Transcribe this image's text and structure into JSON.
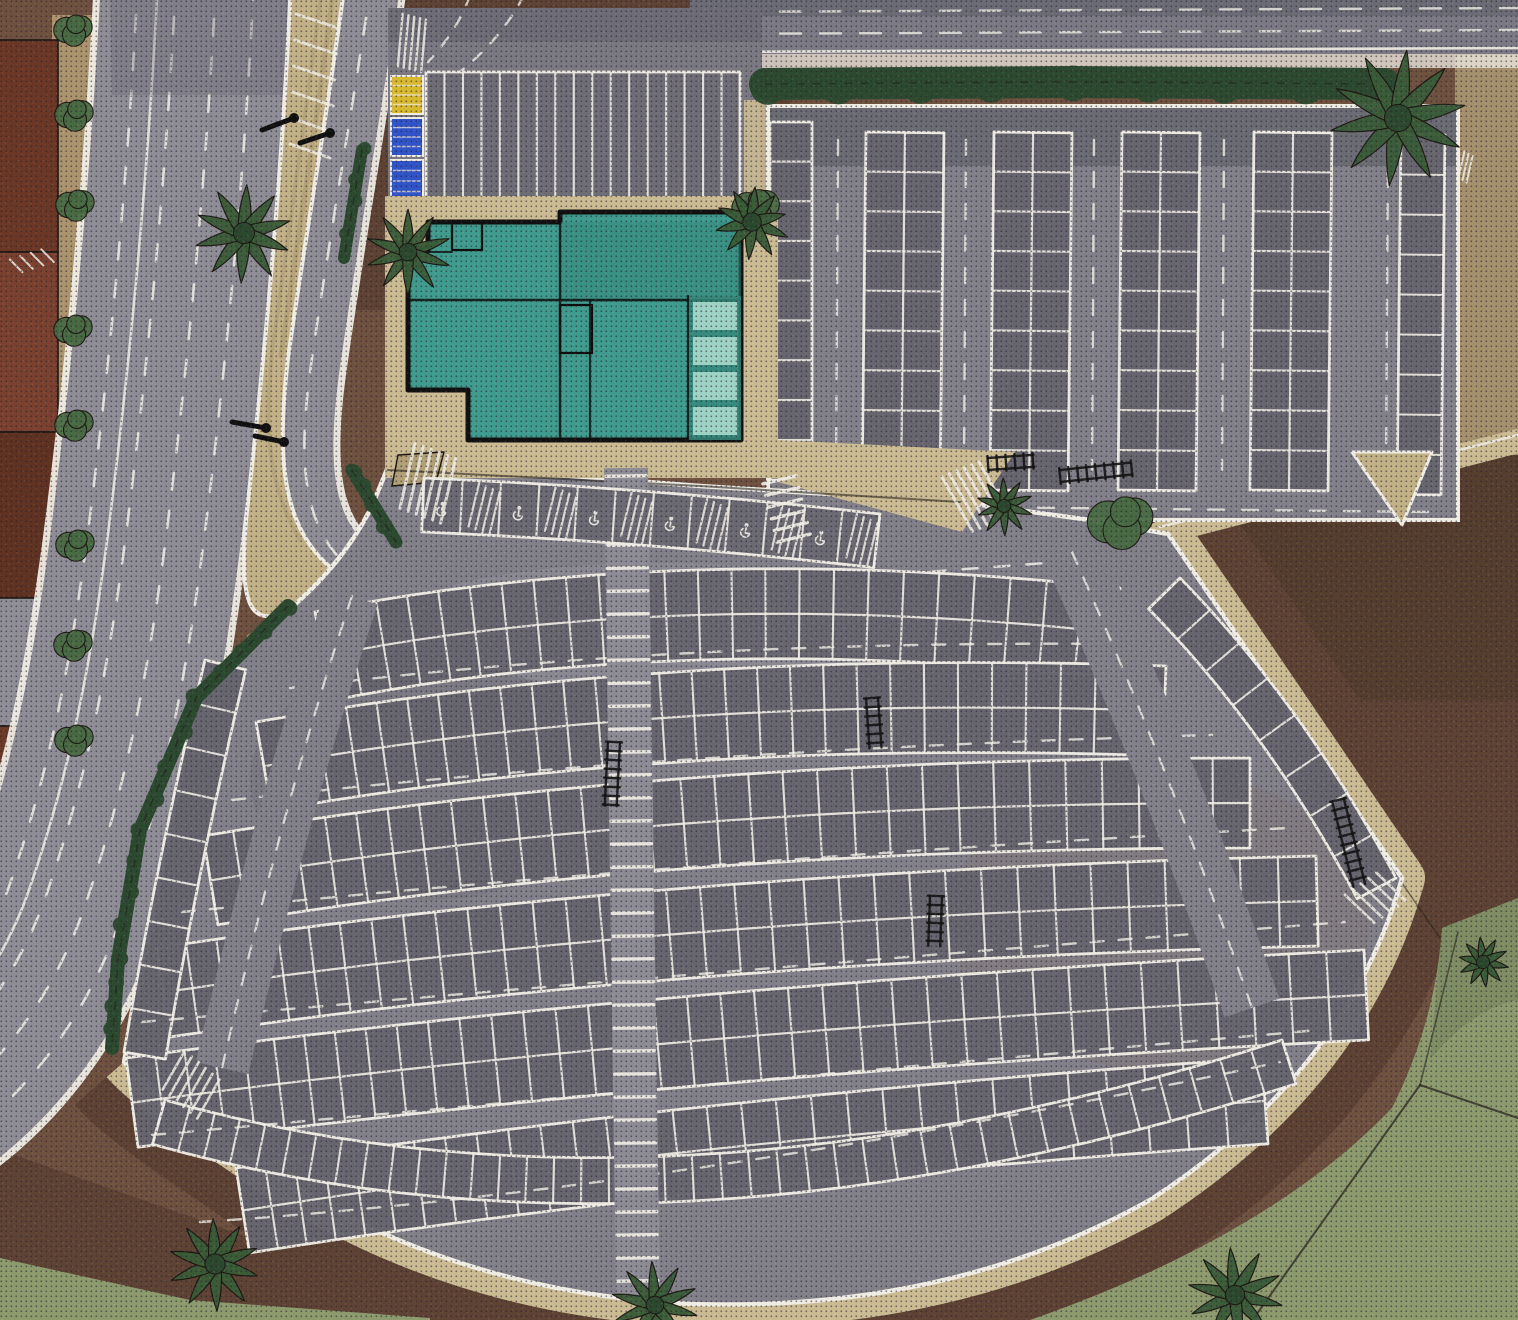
{
  "meta": {
    "description": "Stylized aerial illustration of a shopping-center parking lot, no visible text",
    "style": "hand-drawn halftone aerial view"
  },
  "palette": {
    "base_dirt": "#6f5140",
    "dark_dirt": "#5e4334",
    "deep_dirt": "#513a2c",
    "sand": "#cbbb93",
    "tan": "#c2b186",
    "khaki": "#b1a077",
    "asphalt_road": "#8e8d96",
    "asphalt_road_dark": "#7b7a84",
    "asphalt_lot": "#82818a",
    "asphalt_dark": "#6b6a73",
    "stall_fill": "#67666f",
    "walkway": "#8d8c95",
    "white": "#efece4",
    "teal": "#3f9b8d",
    "teal_dark": "#35887b",
    "teal_light": "#a8d9cc",
    "hedge": "#2c4a2f",
    "palm": "#3a5c38",
    "shrub": "#486b43",
    "grass": "#8c9a6e",
    "grass_dark": "#75855c",
    "roof_red": "#7a4130",
    "roof_red_dark": "#5f3222",
    "roof_gray": "#8f8e96",
    "stall_yellow": "#d6b92e",
    "stall_blue": "#3054c8",
    "ink": "#1c1712"
  },
  "scene": {
    "roads": {
      "arterial_dashed_lanes": 4,
      "top_road_dashed_lanes": 2,
      "entrance_ramp": 1
    },
    "building": {
      "roof_color_key": "teal",
      "skylight_panels": 4
    },
    "forecourt": {
      "stalls": 17,
      "painted_stalls_yellow": 1,
      "painted_stalls_blue": 2
    },
    "ne_lot": {
      "double_row_columns": 4,
      "edge_single_rows": 2,
      "stalls_per_column": 9
    },
    "fan_lot": {
      "row_stalls": [
        24,
        28,
        31,
        34,
        37,
        30,
        40
      ],
      "left_edge_stalls": 9,
      "right_edge_stalls": 8,
      "accessible_stalls": 12,
      "cart_corrals": 6
    },
    "landscaping": {
      "palm_trees": 10,
      "hedge_strips": 4,
      "shrubs": 9,
      "grass_areas": 2
    },
    "furniture": {
      "light_poles": 4,
      "crosswalk_ladders": 2,
      "hatched_islands": 5
    }
  }
}
